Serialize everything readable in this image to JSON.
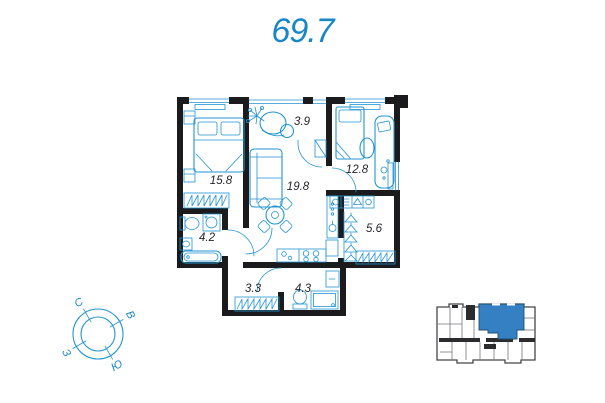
{
  "title": {
    "total_area": "69.7"
  },
  "floor_plan": {
    "rooms": [
      {
        "name": "bedroom",
        "area": "15.8"
      },
      {
        "name": "balcony",
        "area": "3.9"
      },
      {
        "name": "living-kitchen",
        "area": "19.8"
      },
      {
        "name": "bedroom-2",
        "area": "12.8"
      },
      {
        "name": "bathroom",
        "area": "4.2"
      },
      {
        "name": "dressing-room",
        "area": "5.6"
      },
      {
        "name": "hallway",
        "area": "3.3"
      },
      {
        "name": "bathroom-2",
        "area": "4.3"
      }
    ]
  },
  "compass": {
    "north": "С",
    "east": "В",
    "west": "З",
    "south": "Ю"
  },
  "colors": {
    "accent_blue": "#1987c5",
    "plan_line_blue": "#2394d2",
    "wall_black": "#1b1b1d",
    "keyplan_highlight": "#3580c2"
  }
}
